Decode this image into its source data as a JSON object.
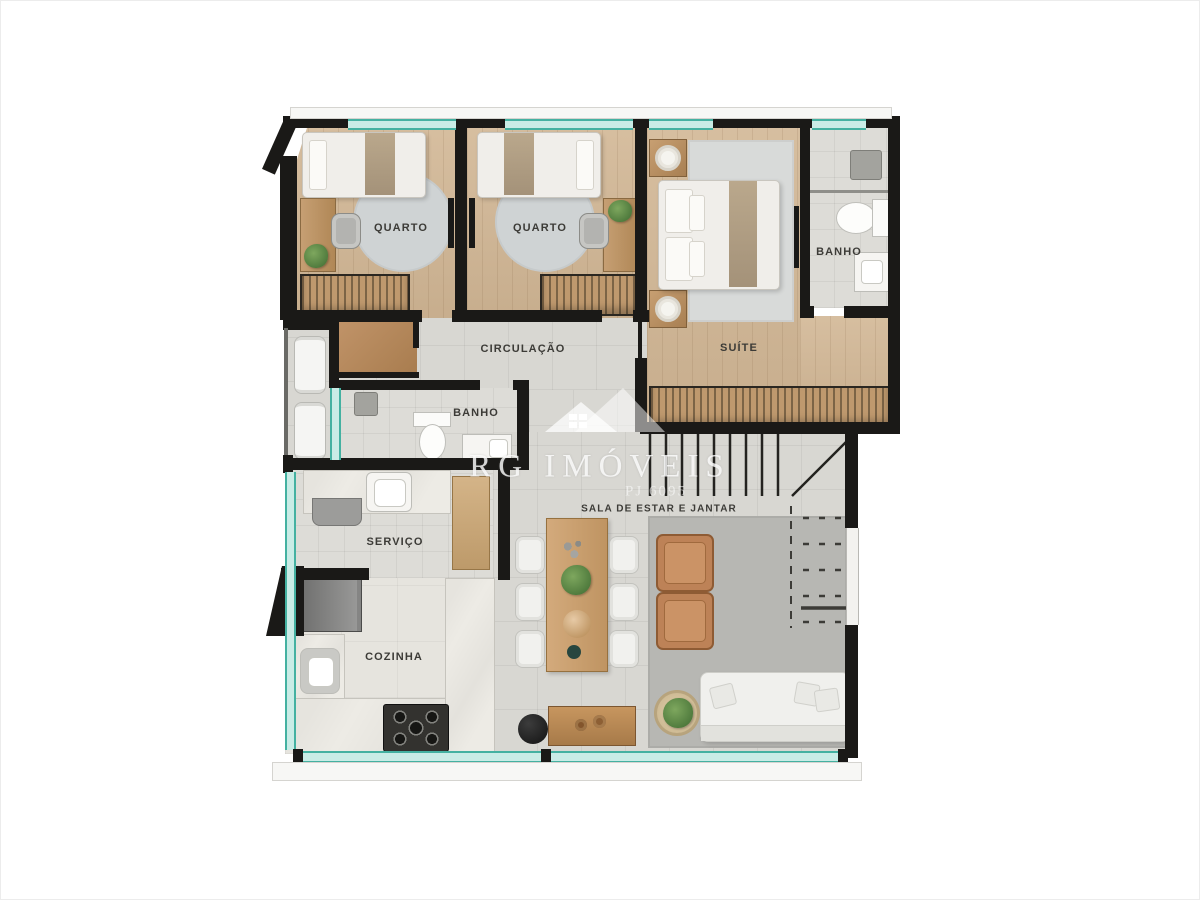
{
  "watermark": {
    "brand": "RG IMÓVEIS",
    "registration": "PJ 6095",
    "logo": "house-logo"
  },
  "plan": {
    "rooms": {
      "quarto1": {
        "label": "QUARTO"
      },
      "quarto2": {
        "label": "QUARTO"
      },
      "banho_suite": {
        "label": "BANHO"
      },
      "suite": {
        "label": "SUÍTE"
      },
      "circulacao": {
        "label": "CIRCULAÇÃO"
      },
      "banho_social": {
        "label": "BANHO"
      },
      "servico": {
        "label": "SERVIÇO"
      },
      "cozinha": {
        "label": "COZINHA"
      },
      "sala": {
        "label": "SALA DE ESTAR E JANTAR"
      }
    },
    "colors": {
      "wall": "#1a1917",
      "window_glass": "#c9ece6",
      "window_frame": "#44b1a1",
      "wood_floor": "#d2b795",
      "tile_floor": "#d8d7d2",
      "living_rug": "#b7b7b3",
      "armchair": "#bd8257",
      "wardrobe_wood": "#bf996e",
      "watermark_white": "#ffffff"
    }
  }
}
